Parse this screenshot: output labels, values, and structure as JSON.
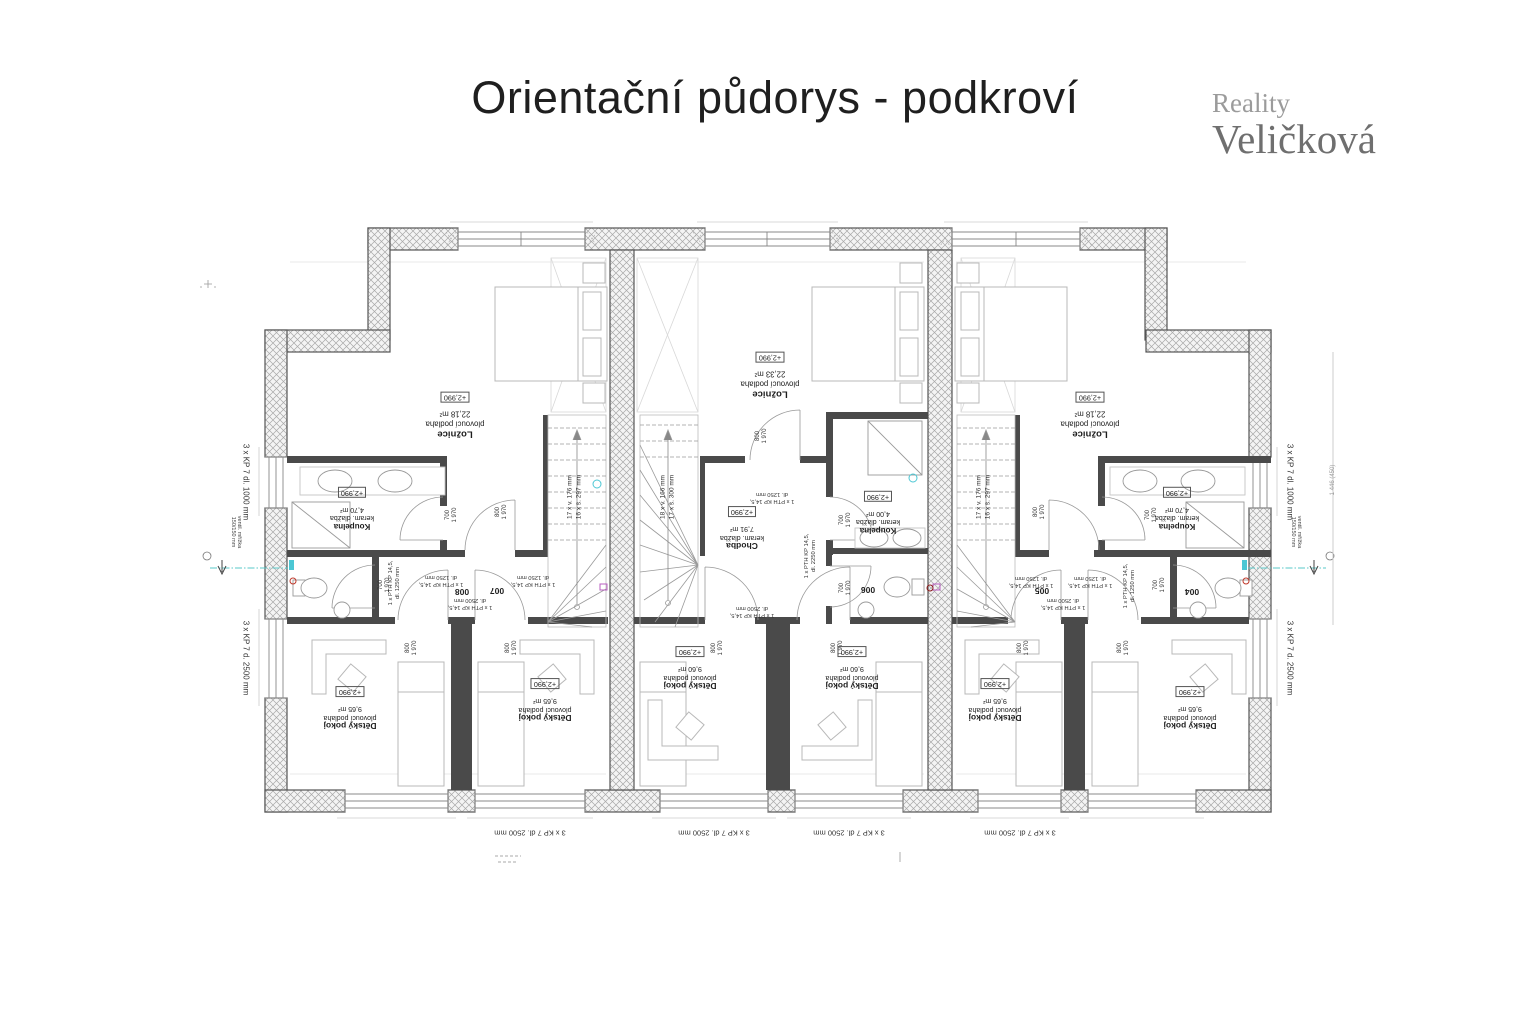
{
  "header": {
    "title": "Orientační půdorys - podkroví",
    "logo_line1": "Reality",
    "logo_line2": "Veličková"
  },
  "colors": {
    "wall_hatch": "#a8a8a8",
    "interior_wall": "#4a4a4a",
    "furniture": "#b8b8b8",
    "plumbing_cyan": "#4cc7d4",
    "mark_magenta": "#b85ec0",
    "mark_red": "#c0392b"
  },
  "rooms": {
    "loznice_left": {
      "name": "Ložnice",
      "floor": "plovoucí podlaha",
      "area": "22,18 m²",
      "level": "+2,990"
    },
    "loznice_center": {
      "name": "Ložnice",
      "floor": "plovoucí podlaha",
      "area": "22,33 m²",
      "level": "+2,990"
    },
    "loznice_right": {
      "name": "Ložnice",
      "floor": "plovoucí podlaha",
      "area": "22,18 m²",
      "level": "+2,990"
    },
    "koupelna_left": {
      "name": "Koupelna",
      "floor": "keram. dlažba",
      "area": "4,70 m²",
      "level": "+2,990"
    },
    "koupelna_center": {
      "name": "Koupelna",
      "floor": "keram. dlažba",
      "area": "4,00 m²",
      "level": "+2,990"
    },
    "koupelna_right": {
      "name": "Koupelna",
      "floor": "keram. dlažba",
      "area": "4,70 m²",
      "level": "+2,990"
    },
    "chodba_center": {
      "name": "Chodba",
      "floor": "keram. dlažba",
      "area": "7,91 m²",
      "level": "+2,990"
    },
    "detsky_left_1": {
      "name": "Dětský pokoj",
      "floor": "plovoucí podlaha",
      "area": "9,65 m²",
      "level": "+2,990"
    },
    "detsky_left_2": {
      "name": "Dětský pokoj",
      "floor": "plovoucí podlaha",
      "area": "9,65 m²",
      "level": "+2,990"
    },
    "detsky_center_1": {
      "name": "Dětský pokoj",
      "floor": "plovoucí podlaha",
      "area": "9,60 m²",
      "level": "+2,990"
    },
    "detsky_center_2": {
      "name": "Dětský pokoj",
      "floor": "plovoucí podlaha",
      "area": "9,60 m²",
      "level": "+2,990"
    },
    "detsky_right_1": {
      "name": "Dětský pokoj",
      "floor": "plovoucí podlaha",
      "area": "9,65 m²",
      "level": "+2,990"
    },
    "detsky_right_2": {
      "name": "Dětský pokoj",
      "floor": "plovoucí podlaha",
      "area": "9,65 m²",
      "level": "+2,990"
    }
  },
  "room_numbers": {
    "wc_right": "004",
    "hall_right": "005",
    "wc_center": "006",
    "hall_left": "007",
    "wc_left": "008"
  },
  "stairs": {
    "side": {
      "line1": "17 x v. 176 mm",
      "line2": "16 x š. 297 mm"
    },
    "center": {
      "line1": "18 x v. 166 mm",
      "line2": "17 x š. 300 mm"
    }
  },
  "lintels": {
    "head": "1 x PTH KP 14,5,",
    "d1250": "dl. 1250 mm",
    "d2250": "dl. 2250 mm",
    "d2500": "dl. 2500 mm"
  },
  "door_dims": {
    "w800": "800",
    "w700": "700",
    "h1970": "1 970"
  },
  "edge_labels": {
    "window_1000": "3 x KP 7 dl. 1000 mm",
    "window_2500_side": "3 x KP 7 d. 2500 mm",
    "window_2500_bottom": "3 x KP 7 dl. 2500 mm",
    "vent_line1": "ventil. mřížka",
    "vent_line2": "150/150 mm",
    "right_dim": "1 446 (450)"
  }
}
